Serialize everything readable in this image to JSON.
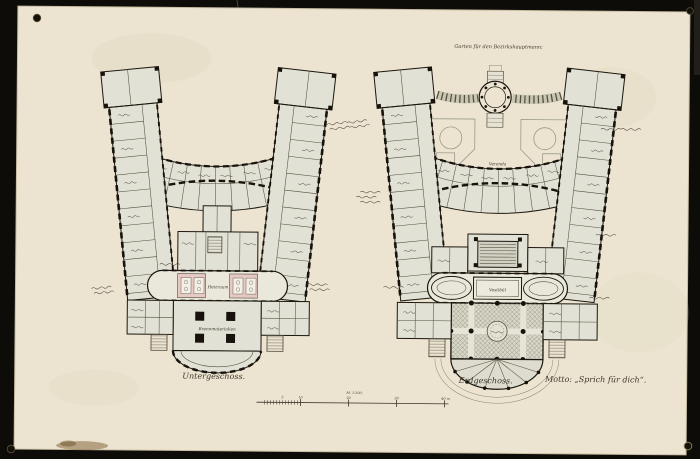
{
  "sheet": {
    "captions": {
      "left_plan": "Untergeschoss.",
      "right_plan": "Erdgeschoss.",
      "motto": "Motto: „Sprich für dich“.",
      "garden_label": "Garten für den Bezirkshauptmann:",
      "veranda_label": "Veranda",
      "scale_label": "M. 1:200."
    },
    "room_labels": {
      "boiler_room": "Heizraum",
      "fuel_cellar": "Brennmaterialien",
      "vestibule": "Vestibül"
    },
    "scale_bar": {
      "ticks": [
        "5",
        "10",
        "20",
        "30",
        "40 m"
      ]
    },
    "colors": {
      "backdrop": "#0e0c09",
      "paper": "#ece4d1",
      "ink": "#1b1710",
      "room_wash": "#e2e1d5",
      "boiler_pink": "#e7c9c3"
    }
  }
}
